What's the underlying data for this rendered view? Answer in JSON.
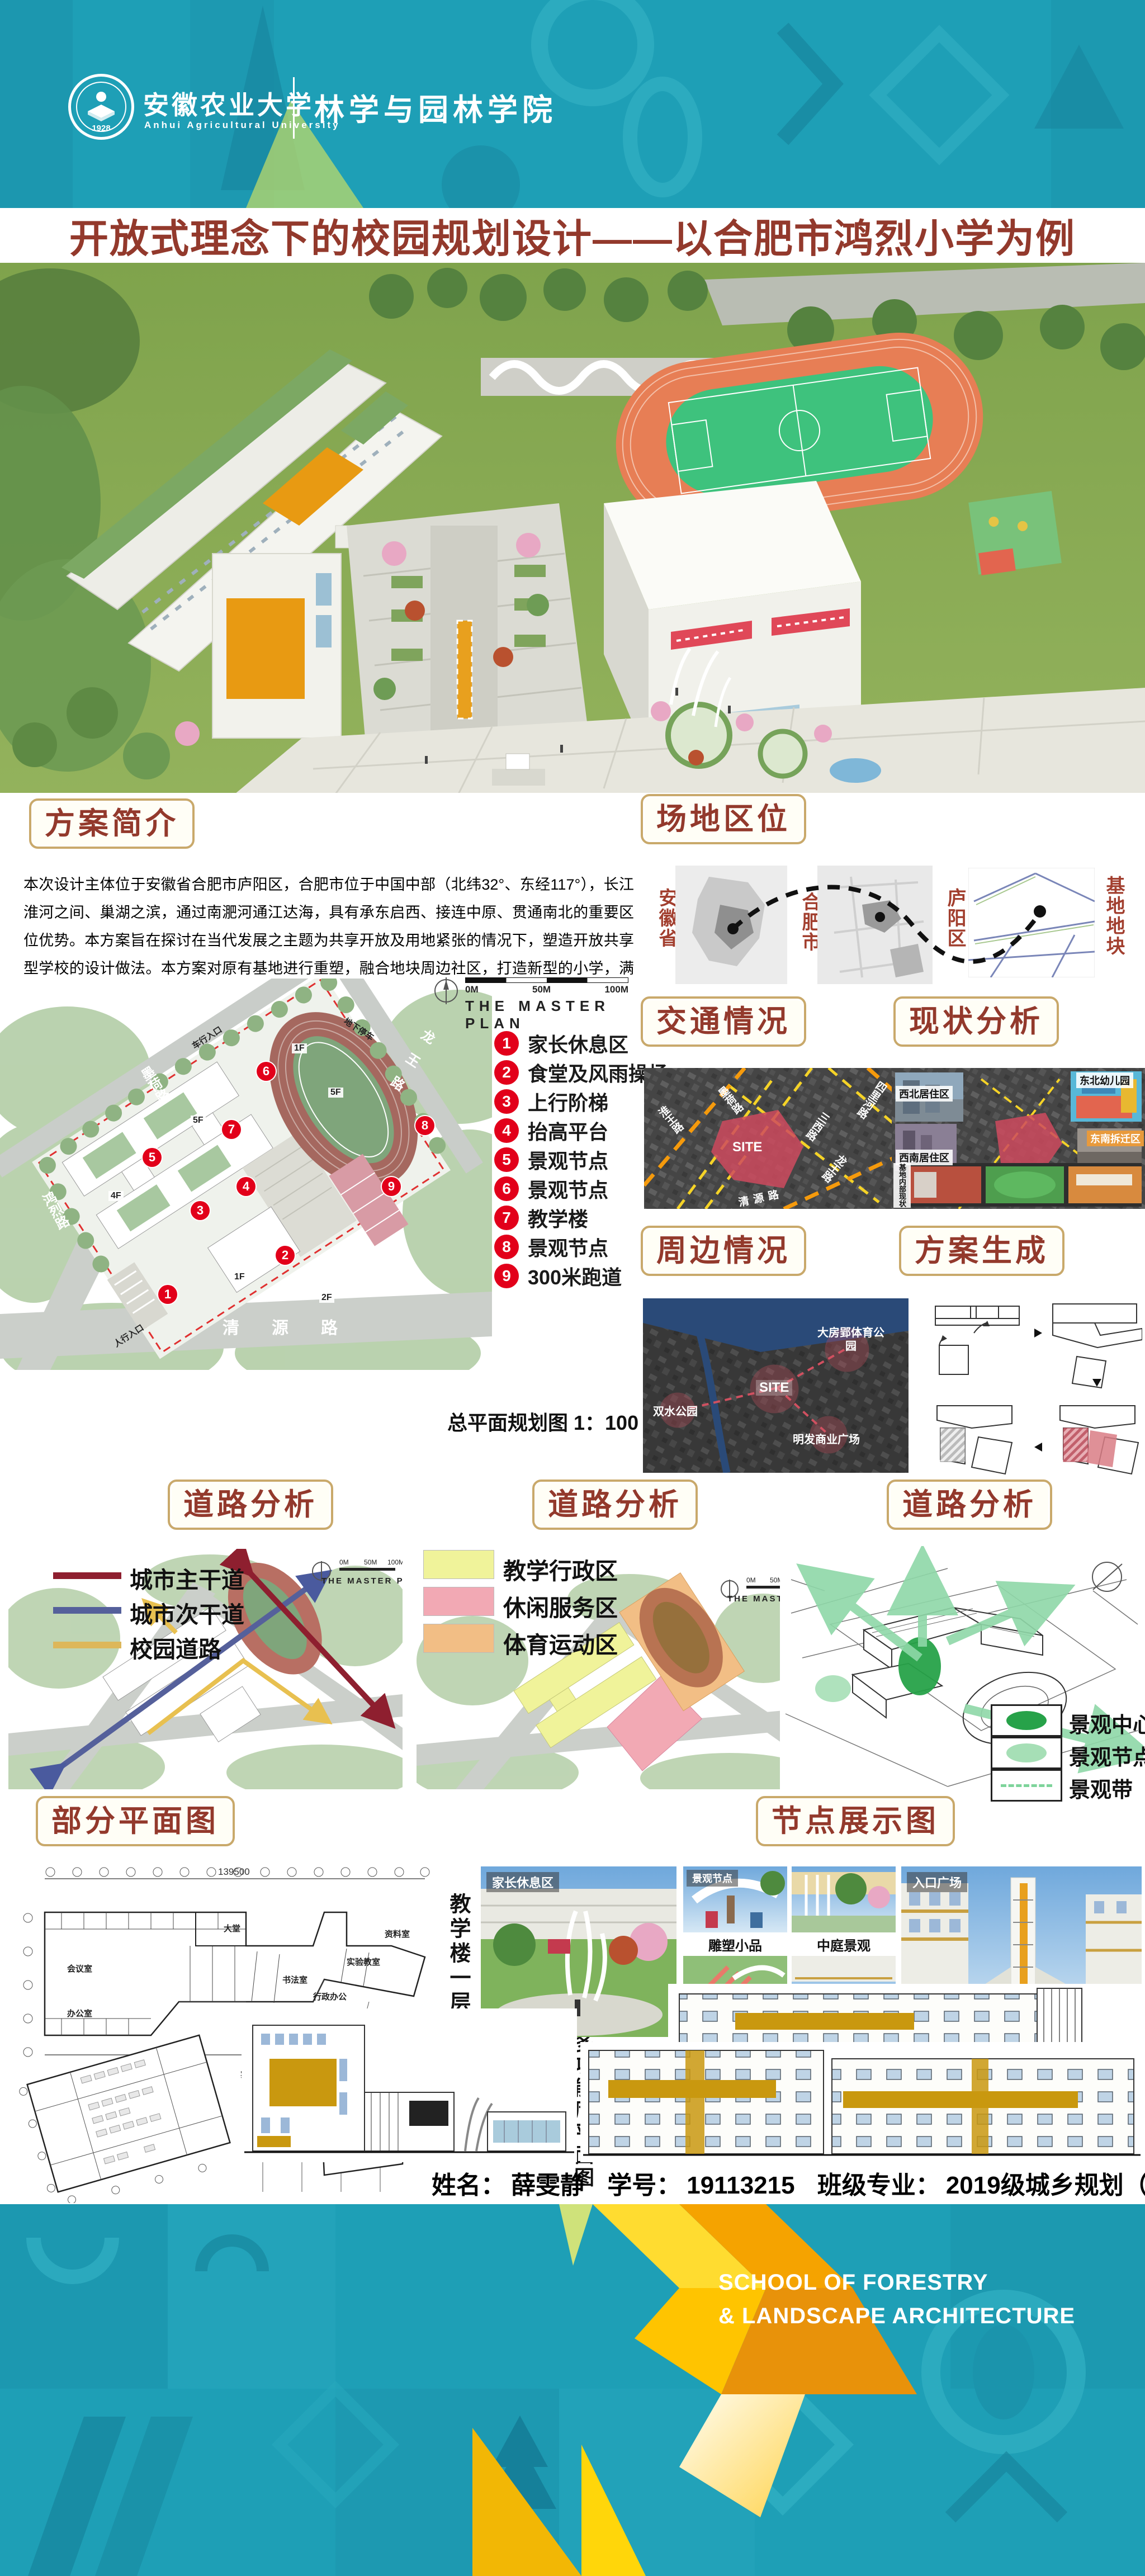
{
  "header": {
    "university_cn": "安徽农业大学",
    "university_en": "Anhui Agricultural University",
    "college": "林学与园林学院",
    "logo_year": "1928"
  },
  "title": "开放式理念下的校园规划设计——以合肥市鸿烈小学为例",
  "intro": {
    "heading": "方案简介",
    "body": "本次设计主体位于安徽省合肥市庐阳区，合肥市位于中国中部（北纬32°、东经117°），长江淮河之间、巢湖之滨，通过南淝河通江达海，具有承东启西、接连中原、贯通南北的重要区位优势。本方案旨在探讨在当代发展之主题为共享开放及用地紧张的情况下，塑造开放共享型学校的设计做法。本方案对原有基地进行重塑，融合地块周边社区，打造新型的小学，满足学生及周边社区的共享使用。"
  },
  "site_location": {
    "heading": "场地区位",
    "province": "安徽省",
    "city": "合肥市",
    "district": "庐阳区",
    "plot": "基地地块"
  },
  "master_plan": {
    "plan_title": "THE MASTER PLAN",
    "scale_ticks": [
      "0M",
      "50M",
      "100M"
    ],
    "legend": [
      {
        "num": "1",
        "label": "家长休息区"
      },
      {
        "num": "2",
        "label": "食堂及风雨操场"
      },
      {
        "num": "3",
        "label": "上行阶梯"
      },
      {
        "num": "4",
        "label": "抬高平台"
      },
      {
        "num": "5",
        "label": "景观节点"
      },
      {
        "num": "6",
        "label": "景观节点"
      },
      {
        "num": "7",
        "label": "教学楼"
      },
      {
        "num": "8",
        "label": "景观节点"
      },
      {
        "num": "9",
        "label": "300米跑道"
      }
    ],
    "roads": {
      "mohe": "墨荷路",
      "longwang": "龙王路",
      "honglie": "鸿烈路",
      "qingyuan": "清源路"
    },
    "entries": {
      "vehicle": "车行入口",
      "pedestrian": "人行入口",
      "underground": "地下停车"
    },
    "floors": [
      "1F",
      "5F",
      "5F",
      "4F",
      "1F",
      "2F"
    ],
    "caption": "总平面规划图  1：100"
  },
  "traffic": {
    "heading": "交通情况",
    "site": "SITE",
    "roads": [
      "淮王路",
      "墨荷路",
      "四里河路",
      "三西路",
      "龙王路",
      "清源路"
    ]
  },
  "status_analysis": {
    "heading": "现状分析",
    "labels": [
      "西北居住区",
      "东北幼儿园",
      "东南拆迁区",
      "西南居住区",
      "基地内部现状"
    ]
  },
  "surroundings": {
    "heading": "周边情况",
    "site": "SITE",
    "labels": [
      "大房郢体育公园",
      "双水公园",
      "明发商业广场"
    ]
  },
  "generation": {
    "heading": "方案生成"
  },
  "road_analysis": {
    "a": {
      "heading": "道路分析",
      "plan_title": "THE MASTER PLAN",
      "legend": [
        {
          "label": "城市主干道",
          "color": "#8E1F2F"
        },
        {
          "label": "城市次干道",
          "color": "#55609B"
        },
        {
          "label": "校园道路",
          "color": "#DDB75A"
        }
      ]
    },
    "b": {
      "heading": "道路分析",
      "plan_title": "THE MASTER PLAN",
      "legend": [
        {
          "label": "教学行政区",
          "color": "#F0F39A"
        },
        {
          "label": "休闲服务区",
          "color": "#F2A9B4"
        },
        {
          "label": "体育运动区",
          "color": "#F2BE85"
        }
      ]
    },
    "c": {
      "heading": "道路分析",
      "legend": [
        {
          "label": "景观中心",
          "color": "#27A249"
        },
        {
          "label": "景观节点",
          "color": "#A6DFB6"
        },
        {
          "label": "景观带",
          "color": "#7ED49B"
        }
      ]
    }
  },
  "partial_plans": {
    "heading": "部分平面图",
    "caption_teaching": "教学楼一层平面图",
    "caption_canteen": "食堂多功能厅平面图",
    "rooms": {
      "hall": "大堂",
      "office": "办公室",
      "meeting": "会议室",
      "calligraphy": "书法室",
      "archive": "资料室",
      "lab": "实验教室",
      "art": "美术教育",
      "admin": "行政办公",
      "lecture": "报告厅",
      "reading": "借阅室"
    },
    "entries": {
      "teaching": "教学楼入口",
      "lab_main": "实验室入口",
      "lab_side": "实验室次入口"
    },
    "dims": {
      "total_top": "139500",
      "total_left": "56000",
      "d1": "29700",
      "d2": "42600"
    }
  },
  "nodes": {
    "heading": "节点展示图",
    "photo_labels": [
      "家长休息区",
      "景观节点",
      "入口广场"
    ],
    "captions": [
      "雕塑小品",
      "中庭景观",
      "交流长廊",
      "上行平台"
    ]
  },
  "elevations": {
    "heading": "立面展示图"
  },
  "author": {
    "name_label": "姓名：",
    "name": "薛雯静",
    "id_label": "学号：",
    "id": "19113215",
    "class_label": "班级专业：",
    "class": "2019级城乡规划（1）班"
  },
  "footer": {
    "line1": "SCHOOL OF FORESTRY",
    "line2": "& LANDSCAPE ARCHITECTURE"
  },
  "colors": {
    "teal": "#1E9FB6",
    "maroon": "#93392C",
    "box_border": "#C9A96B",
    "marker_red": "#E2001A",
    "accent_orange": "#E89A12",
    "track_orange": "#E77E55",
    "field_green": "#3EC27D",
    "gold": "#F5B301"
  }
}
